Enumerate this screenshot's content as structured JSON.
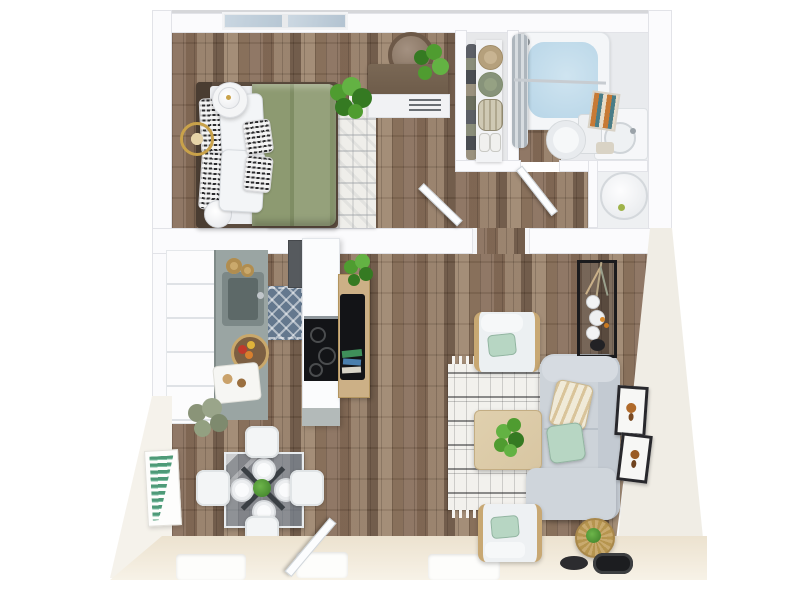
{
  "scene": {
    "kind": "3d-rendered-floor-plan",
    "view": "top-down",
    "background": "white"
  },
  "theme": {
    "colors": {
      "wall": "#fbfbfd",
      "wallEdge": "#e2e3e8",
      "woodBase": "#8c7360",
      "woodMid": "#7a614d",
      "woodPale": "#97806a",
      "woodDark": "#6d5745",
      "woodLight": "#a18a73",
      "beige": "#ece2cf",
      "beigeLight": "#f7f2e7",
      "creamFace": "#f0ede5",
      "duvet": "#8d9a71",
      "duvetFold": "#7f8d64",
      "mint": "#b7d6c3",
      "sofa": "#cdd3d9",
      "sofaBack": "#c3cad2",
      "livingRug": "#f2f1ed",
      "bedroomRug": "#efeeea",
      "kitchenRug": "#64788e",
      "counter": "#9aa5a3",
      "sinkDark": "#5d6968",
      "barWood": "#ccb086",
      "tvBlack": "#131417",
      "consoleBlack": "#1b1b1d",
      "gold": "#c9a24a",
      "furnWood": "#6e5c4a",
      "headboard": "#4a3d32",
      "coffeeTable": "#d8c6a2",
      "tubWater": "#b7d5e7",
      "glass": "#7d96aa",
      "plantGreen": "#4f9c30",
      "plantDark": "#357a22",
      "plantLight": "#63b243",
      "plantSage": "#8a9478",
      "artGreen": "#4e9a78",
      "hatTan": "#c8b492",
      "hatSage": "#95a183"
    }
  },
  "rooms": {
    "bedroom": {
      "label": "Bedroom",
      "items": [
        "window",
        "bed",
        "green-duvet",
        "white-pillows",
        "patterned-pillows",
        "area-rug",
        "nightstand",
        "table-lamp",
        "gold-accent-table",
        "floor-lamp",
        "monstera-plant",
        "dresser",
        "round-mirror",
        "dresser-plant"
      ]
    },
    "closet": {
      "label": "Closet",
      "items": [
        "shelf",
        "sun-hat-tan",
        "sun-hat-sage",
        "storage-basket",
        "shoes",
        "hanging-clothes"
      ]
    },
    "bathroom": {
      "label": "Bathroom",
      "items": [
        "bathtub",
        "shower-curtain",
        "curtain-rod",
        "toilet",
        "vanity-sink",
        "wall-art",
        "towel"
      ]
    },
    "hallway": {
      "label": "Hallway",
      "items": [
        "bedroom-door",
        "bathroom-door",
        "utility-closet",
        "water-heater"
      ]
    },
    "kitchen": {
      "label": "Kitchen",
      "items": [
        "cabinet-run",
        "countertop",
        "sink",
        "faucet",
        "wood-bowls",
        "fruit-bowl",
        "cutting-board",
        "kitchen-rug",
        "refrigerator",
        "island-counter",
        "stove",
        "bar-shelf",
        "tv",
        "cookbooks",
        "bar-plant",
        "potted-plant"
      ]
    },
    "dining": {
      "label": "Dining Area",
      "items": [
        "glass-table",
        "table-base",
        "dining-chairs",
        "plates",
        "centerpiece-plant",
        "green-wall-art"
      ]
    },
    "living": {
      "label": "Living Room",
      "items": [
        "sofa",
        "throw-pillows",
        "armchair-top",
        "armchair-bottom",
        "area-rug",
        "coffee-table",
        "coffee-table-plant",
        "black-console",
        "vases",
        "dried-plant",
        "round-side-table",
        "side-table-plant",
        "framed-art",
        "entry-door",
        "black-trays"
      ]
    }
  }
}
